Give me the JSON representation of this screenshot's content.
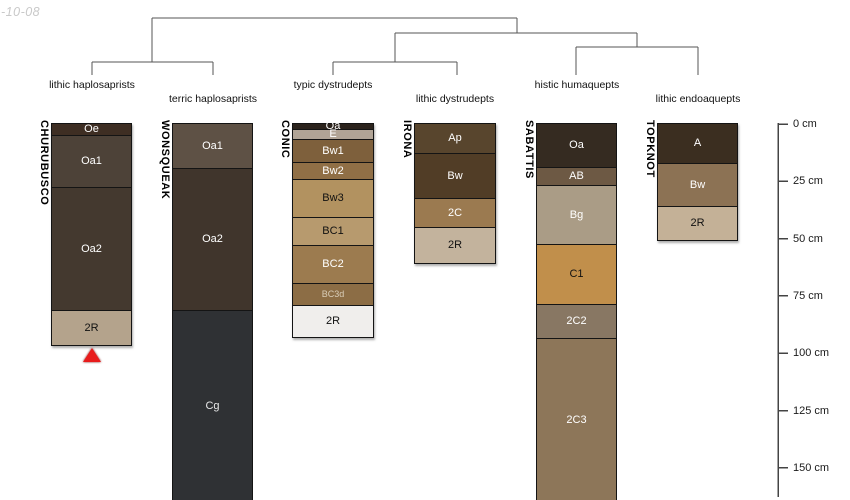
{
  "watermark": "-10-08",
  "chart_data": {
    "type": "soil-profile-dendrogram",
    "depth_unit": "cm",
    "canvas": {
      "width": 850,
      "height": 500
    },
    "px_per_cm": 2.293,
    "depth_zero_y_px": 124,
    "column_top_y_px": 123,
    "colors": {
      "tree_line": "#555555",
      "axis_line": "#444444",
      "column_border": "#141414",
      "marker_red": "#e81b1b",
      "watermark_gray": "#c9c9c9"
    },
    "depth_axis": {
      "x_px": 778,
      "tick_length_px": 10,
      "label_x_px": 793,
      "line_bottom_y_px": 497,
      "ticks": [
        {
          "label": "0 cm",
          "cm": 0
        },
        {
          "label": "25 cm",
          "cm": 25
        },
        {
          "label": "50 cm",
          "cm": 50
        },
        {
          "label": "75 cm",
          "cm": 75
        },
        {
          "label": "100 cm",
          "cm": 100
        },
        {
          "label": "125 cm",
          "cm": 125
        },
        {
          "label": "150 cm",
          "cm": 150
        }
      ]
    },
    "dendrogram": {
      "labels": [
        {
          "text": "lithic haplosaprists",
          "x": 92,
          "row": "upper"
        },
        {
          "text": "terric haplosaprists",
          "x": 213,
          "row": "lower"
        },
        {
          "text": "typic dystrudepts",
          "x": 333,
          "row": "upper"
        },
        {
          "text": "lithic dystrudepts",
          "x": 455,
          "row": "lower"
        },
        {
          "text": "histic humaquepts",
          "x": 577,
          "row": "upper"
        },
        {
          "text": "lithic endoaquepts",
          "x": 698,
          "row": "lower"
        }
      ],
      "label_row_y": {
        "upper": 79,
        "lower": 93
      },
      "segments": [
        [
          152,
          18,
          517,
          18
        ],
        [
          152,
          18,
          152,
          62
        ],
        [
          92,
          62,
          213,
          62
        ],
        [
          92,
          62,
          92,
          75
        ],
        [
          213,
          62,
          213,
          75
        ],
        [
          517,
          18,
          517,
          33
        ],
        [
          395,
          33,
          637,
          33
        ],
        [
          395,
          33,
          395,
          62
        ],
        [
          333,
          62,
          457,
          62
        ],
        [
          333,
          62,
          333,
          75
        ],
        [
          457,
          62,
          457,
          75
        ],
        [
          637,
          33,
          637,
          47
        ],
        [
          576,
          47,
          698,
          47
        ],
        [
          576,
          47,
          576,
          75
        ],
        [
          698,
          47,
          698,
          75
        ]
      ]
    },
    "profiles": [
      {
        "name": "CHURUBUSCO",
        "taxon": "lithic haplosaprists",
        "x_left_px": 52,
        "width_px": 79,
        "truncated": false,
        "marker": {
          "type": "red-triangle",
          "depth_cm": 97.5
        },
        "horizons": [
          {
            "name": "Oe",
            "top_cm": 0,
            "bottom_cm": 5,
            "color": "#3e2e23",
            "text_color": "#ffffff"
          },
          {
            "name": "Oa1",
            "top_cm": 5,
            "bottom_cm": 27.5,
            "color": "#4d4238",
            "text_color": "#ffffff"
          },
          {
            "name": "Oa2",
            "top_cm": 27.5,
            "bottom_cm": 81,
            "color": "#44392f",
            "text_color": "#ffffff"
          },
          {
            "name": "2R",
            "top_cm": 81,
            "bottom_cm": 96.5,
            "color": "#b4a38c",
            "text_color": "#111111"
          }
        ]
      },
      {
        "name": "WONSQUEAK",
        "taxon": "terric haplosaprists",
        "x_left_px": 173,
        "width_px": 79,
        "truncated": true,
        "horizons": [
          {
            "name": "Oa1",
            "top_cm": 0,
            "bottom_cm": 19,
            "color": "#5e5145",
            "text_color": "#ffffff"
          },
          {
            "name": "Oa2",
            "top_cm": 19,
            "bottom_cm": 81,
            "color": "#40352c",
            "text_color": "#ffffff"
          },
          {
            "name": "Cg",
            "top_cm": 81,
            "bottom_cm": 165,
            "color": "#2f3134",
            "text_color": "#e8e8e8"
          }
        ]
      },
      {
        "name": "CONIC",
        "taxon": "typic dystrudepts",
        "x_left_px": 293,
        "width_px": 80,
        "truncated": false,
        "horizons": [
          {
            "name": "Oa",
            "top_cm": 0,
            "bottom_cm": 2.2,
            "color": "#2b231c",
            "text_color": "#ffffff"
          },
          {
            "name": "E",
            "top_cm": 2.2,
            "bottom_cm": 6.5,
            "color": "#b1a496",
            "text_color": "#ffffff"
          },
          {
            "name": "Bw1",
            "top_cm": 6.5,
            "bottom_cm": 16.6,
            "color": "#7e603c",
            "text_color": "#ffffff"
          },
          {
            "name": "Bw2",
            "top_cm": 16.6,
            "bottom_cm": 24,
            "color": "#906f46",
            "text_color": "#ffffff"
          },
          {
            "name": "Bw3",
            "top_cm": 24,
            "bottom_cm": 40.6,
            "color": "#b29260",
            "text_color": "#111111"
          },
          {
            "name": "BC1",
            "top_cm": 40.6,
            "bottom_cm": 52.8,
            "color": "#b79a6e",
            "text_color": "#111111"
          },
          {
            "name": "BC2",
            "top_cm": 52.8,
            "bottom_cm": 69.3,
            "color": "#9c7b4f",
            "text_color": "#ffffff"
          },
          {
            "name": "BC3d",
            "top_cm": 69.3,
            "bottom_cm": 78.9,
            "color": "#8c6d45",
            "text_color": "#d9cdb8",
            "small_label": true
          },
          {
            "name": "2R",
            "top_cm": 78.9,
            "bottom_cm": 92.9,
            "color": "#f0eeec",
            "text_color": "#111111"
          }
        ]
      },
      {
        "name": "IRONA",
        "taxon": "lithic dystrudepts",
        "x_left_px": 415,
        "width_px": 80,
        "truncated": false,
        "horizons": [
          {
            "name": "Ap",
            "top_cm": 0,
            "bottom_cm": 12.6,
            "color": "#58452d",
            "text_color": "#ffffff"
          },
          {
            "name": "Bw",
            "top_cm": 12.6,
            "bottom_cm": 32.3,
            "color": "#513d26",
            "text_color": "#ffffff"
          },
          {
            "name": "2C",
            "top_cm": 32.3,
            "bottom_cm": 44.9,
            "color": "#9b7a50",
            "text_color": "#ffffff"
          },
          {
            "name": "2R",
            "top_cm": 44.9,
            "bottom_cm": 60.6,
            "color": "#c3b39d",
            "text_color": "#111111"
          }
        ]
      },
      {
        "name": "SABATTIS",
        "taxon": "histic humaquepts",
        "x_left_px": 537,
        "width_px": 79,
        "truncated": true,
        "horizons": [
          {
            "name": "Oa",
            "top_cm": 0,
            "bottom_cm": 18.8,
            "color": "#352b21",
            "text_color": "#ffffff"
          },
          {
            "name": "AB",
            "top_cm": 18.8,
            "bottom_cm": 26.6,
            "color": "#6d5944",
            "text_color": "#ffffff"
          },
          {
            "name": "Bg",
            "top_cm": 26.6,
            "bottom_cm": 52.3,
            "color": "#aa9c86",
            "text_color": "#ffffff"
          },
          {
            "name": "C1",
            "top_cm": 52.3,
            "bottom_cm": 78.5,
            "color": "#c18f4b",
            "text_color": "#111111"
          },
          {
            "name": "2C2",
            "top_cm": 78.5,
            "bottom_cm": 93.3,
            "color": "#887763",
            "text_color": "#ffffff"
          },
          {
            "name": "2C3",
            "top_cm": 93.3,
            "bottom_cm": 165,
            "color": "#8d7659",
            "text_color": "#ffffff"
          }
        ]
      },
      {
        "name": "TOPKNOT",
        "taxon": "lithic endoaquepts",
        "x_left_px": 658,
        "width_px": 79,
        "truncated": false,
        "horizons": [
          {
            "name": "A",
            "top_cm": 0,
            "bottom_cm": 17,
            "color": "#3b2e20",
            "text_color": "#ffffff"
          },
          {
            "name": "Bw",
            "top_cm": 17,
            "bottom_cm": 35.8,
            "color": "#8c7254",
            "text_color": "#ffffff"
          },
          {
            "name": "2R",
            "top_cm": 35.8,
            "bottom_cm": 50.6,
            "color": "#c4b197",
            "text_color": "#111111"
          }
        ]
      }
    ]
  }
}
